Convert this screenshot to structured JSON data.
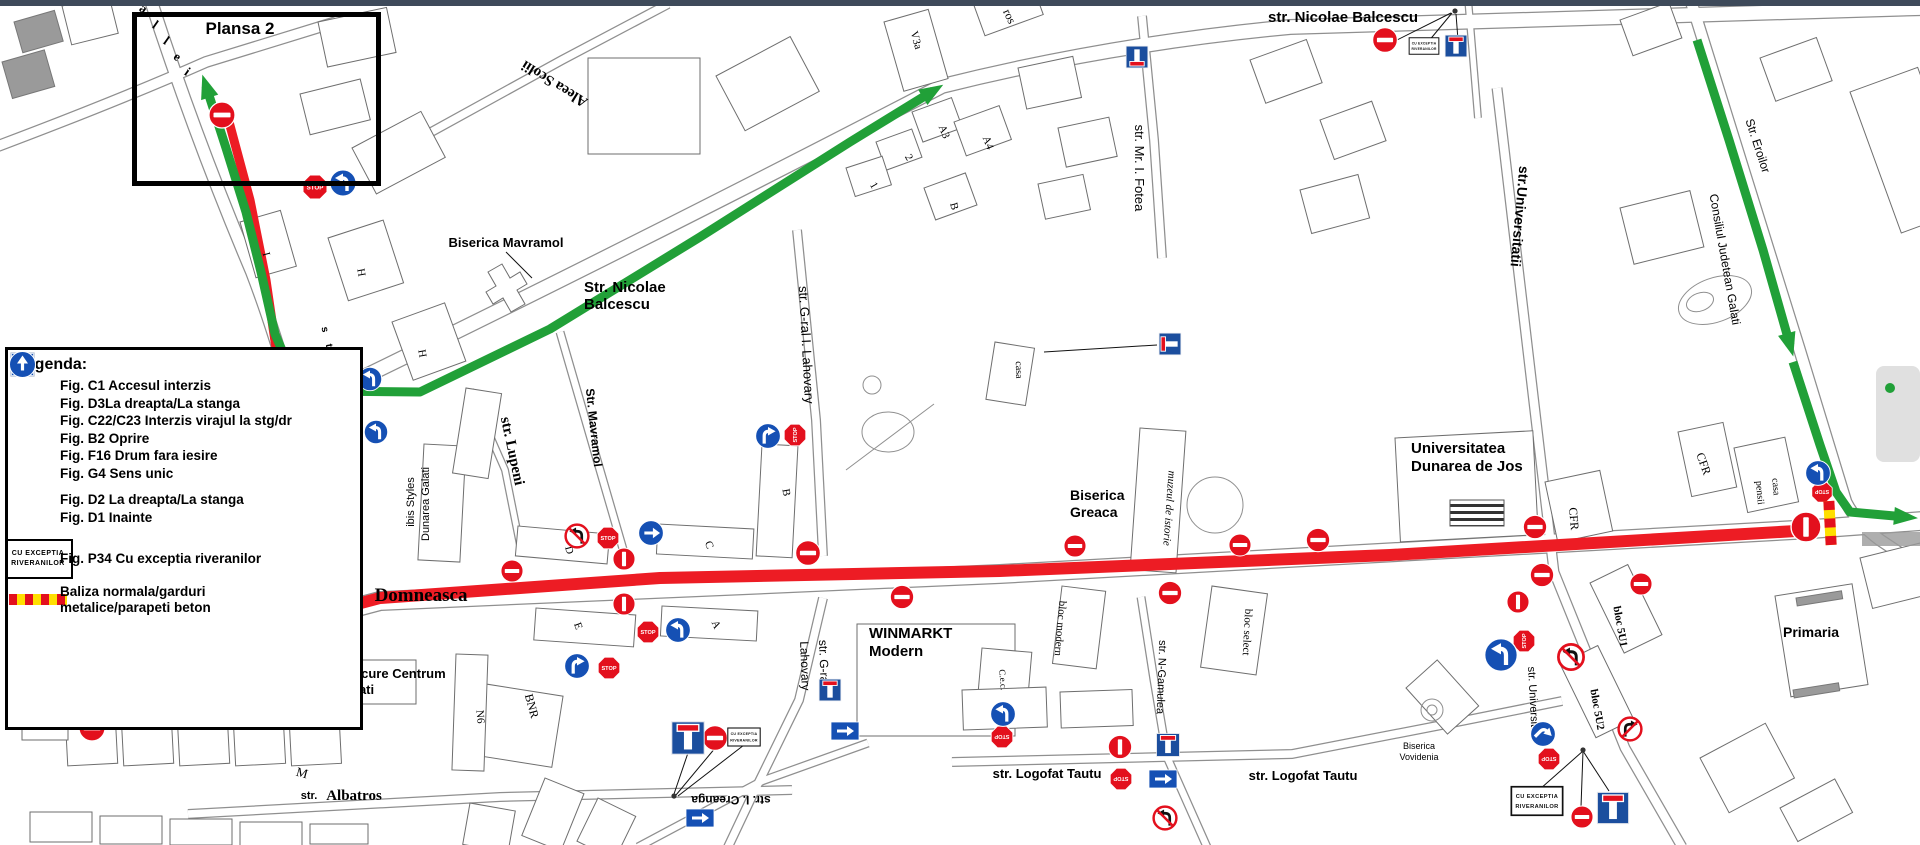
{
  "chrome": {
    "top_bar_color": "#3e4a5a"
  },
  "colors": {
    "route_red": "#ed1c24",
    "route_green": "#21a038",
    "sign_red": "#e3101d",
    "sign_blue": "#1550b4",
    "f16_blue": "#1b4e9e",
    "bal_yellow": "#ffdf00"
  },
  "plansa_box": {
    "label": "Plansa 2"
  },
  "sign_text": {
    "stop": "STOP",
    "p34_line1": "CU  EXCEPTIA",
    "p34_line2": "RIVERANILOR"
  },
  "legend": {
    "title": "Legenda:",
    "items": [
      {
        "icon": "ne",
        "label": "Fig. C1 Accesul interzis"
      },
      {
        "icon": "d3r",
        "label": "Fig. D3La dreapta/La stanga"
      },
      {
        "icon": "ntl",
        "label": "Fig. C22/C23 Interzis virajul la stg/dr"
      },
      {
        "icon": "st",
        "label": "Fig. B2 Oprire"
      },
      {
        "icon": "f16",
        "label": "Fig. F16 Drum fara iesire"
      },
      {
        "icon": "g4up",
        "label": "Fig. G4 Sens unic"
      },
      {
        "icon": "gap",
        "label": ""
      },
      {
        "icon": "d2r",
        "label": "Fig. D2 La dreapta/La stanga"
      },
      {
        "icon": "d1up",
        "label": "Fig. D1 Inainte"
      },
      {
        "icon": "gap",
        "label": ""
      },
      {
        "icon": "p34",
        "label": "Fig. P34 Cu exceptia riveranilor"
      },
      {
        "icon": "bal",
        "label": "Baliza normala/garduri",
        "label2": "metalice/parapeti beton"
      }
    ]
  },
  "street_labels": [
    {
      "t": "Plansa 2",
      "x": 240,
      "y": 34,
      "s": 17,
      "b": 1
    },
    {
      "t": "Aleea Scolii",
      "x": 557,
      "y": 80,
      "s": 15,
      "b": 1,
      "f": 1,
      "r": 212
    },
    {
      "t": "Biserica Mavramol",
      "x": 506,
      "y": 247,
      "s": 13,
      "b": 1
    },
    {
      "t": "Str. Nicolae",
      "x": 584,
      "y": 292,
      "s": 15,
      "b": 1,
      "a": "start"
    },
    {
      "t": "Balcescu",
      "x": 584,
      "y": 309,
      "s": 15,
      "b": 1,
      "a": "start"
    },
    {
      "t": "str. Nicolae Balcescu",
      "x": 1268,
      "y": 22,
      "s": 15,
      "b": 1,
      "a": "start"
    },
    {
      "t": "str. Mr. I. Fotea",
      "x": 1135,
      "y": 168,
      "s": 13,
      "r": 90
    },
    {
      "t": "str. G-ral I. Lahovary",
      "x": 802,
      "y": 345,
      "s": 13,
      "r": 87
    },
    {
      "t": "str. G-ral I.",
      "x": 820,
      "y": 668,
      "s": 12,
      "r": 88
    },
    {
      "t": "Lahovary",
      "x": 801,
      "y": 666,
      "s": 12,
      "r": 88
    },
    {
      "t": "Str. Mavramol",
      "x": 590,
      "y": 428,
      "s": 12,
      "b": 1,
      "r": 84
    },
    {
      "t": "str. Lupeni",
      "x": 508,
      "y": 452,
      "s": 15,
      "b": 1,
      "f": 1,
      "r": 78
    },
    {
      "t": "ibis Styles",
      "x": 414,
      "y": 502,
      "s": 11,
      "r": -90
    },
    {
      "t": "Dunarea Galati",
      "x": 429,
      "y": 504,
      "s": 11,
      "r": -90
    },
    {
      "t": "str.",
      "x": 352,
      "y": 599,
      "s": 13,
      "b": 1
    },
    {
      "t": "Domneasca",
      "x": 421,
      "y": 601,
      "s": 19,
      "b": 1,
      "f": 1
    },
    {
      "t": "Mercure Centrum",
      "x": 338,
      "y": 678,
      "s": 13,
      "b": 1,
      "a": "start"
    },
    {
      "t": "Galati",
      "x": 338,
      "y": 694,
      "s": 13,
      "b": 1,
      "a": "start"
    },
    {
      "t": "str.",
      "x": 309,
      "y": 799,
      "s": 11,
      "b": 1
    },
    {
      "t": "Albatros",
      "x": 354,
      "y": 800,
      "s": 15,
      "b": 1,
      "f": 1
    },
    {
      "t": "WINMARKT",
      "x": 869,
      "y": 638,
      "s": 15,
      "b": 1,
      "a": "start"
    },
    {
      "t": "Modern",
      "x": 869,
      "y": 656,
      "s": 15,
      "b": 1,
      "a": "start"
    },
    {
      "t": "str. I. Creanga",
      "x": 731,
      "y": 796,
      "s": 12,
      "b": 1,
      "r": 180
    },
    {
      "t": "str. Logofat Tautu",
      "x": 1047,
      "y": 778,
      "s": 13,
      "b": 1
    },
    {
      "t": "str. Logofat Tautu",
      "x": 1303,
      "y": 780,
      "s": 13,
      "b": 1
    },
    {
      "t": "str. N-Gamulea",
      "x": 1158,
      "y": 677,
      "s": 11,
      "r": 92
    },
    {
      "t": "bloc modern",
      "x": 1057,
      "y": 628,
      "s": 11,
      "f": 1,
      "r": 95
    },
    {
      "t": "bloc select",
      "x": 1244,
      "y": 632,
      "s": 11,
      "f": 1,
      "r": 93
    },
    {
      "t": "C.e.c.",
      "x": 1000,
      "y": 680,
      "s": 9,
      "f": 1,
      "r": 85
    },
    {
      "t": "muzeul de istorie",
      "x": 1166,
      "y": 508,
      "s": 11,
      "f": 1,
      "i": 1,
      "r": 94
    },
    {
      "t": "Biserica",
      "x": 1070,
      "y": 500,
      "s": 14,
      "b": 1,
      "a": "start"
    },
    {
      "t": "Greaca",
      "x": 1070,
      "y": 517,
      "s": 14,
      "b": 1,
      "a": "start"
    },
    {
      "t": "casa",
      "x": 1016,
      "y": 370,
      "s": 10,
      "f": 1,
      "r": 88
    },
    {
      "t": "Universitatea",
      "x": 1411,
      "y": 453,
      "s": 15,
      "b": 1,
      "a": "start"
    },
    {
      "t": "Dunarea de Jos",
      "x": 1411,
      "y": 471,
      "s": 15,
      "b": 1,
      "a": "start"
    },
    {
      "t": "CFR",
      "x": 1570,
      "y": 519,
      "s": 12,
      "f": 1,
      "r": 85
    },
    {
      "t": "CFR",
      "x": 1700,
      "y": 465,
      "s": 12,
      "f": 1,
      "r": 70
    },
    {
      "t": "casa",
      "x": 1773,
      "y": 487,
      "s": 10,
      "f": 1,
      "r": 85
    },
    {
      "t": "pensii",
      "x": 1757,
      "y": 493,
      "s": 10,
      "f": 1,
      "r": 85
    },
    {
      "t": "str.Universitatii",
      "x": 1515,
      "y": 216,
      "s": 14,
      "b": 1,
      "r": 95
    },
    {
      "t": "Str. Eroilor",
      "x": 1754,
      "y": 147,
      "s": 12,
      "r": 72
    },
    {
      "t": "Consiliul Judetean Galati",
      "x": 1721,
      "y": 260,
      "s": 12,
      "r": 80
    },
    {
      "t": "str. Universitatii",
      "x": 1530,
      "y": 704,
      "s": 11,
      "r": 87
    },
    {
      "t": "Primaria",
      "x": 1811,
      "y": 637,
      "s": 14,
      "b": 1
    },
    {
      "t": "Biserica",
      "x": 1419,
      "y": 749,
      "s": 9
    },
    {
      "t": "Vovidenia",
      "x": 1419,
      "y": 760,
      "s": 9
    },
    {
      "t": "bloc 5U1",
      "x": 1617,
      "y": 627,
      "s": 11,
      "b": 1,
      "f": 1,
      "r": 80
    },
    {
      "t": "bloc 5U2",
      "x": 1594,
      "y": 710,
      "s": 11,
      "b": 1,
      "f": 1,
      "r": 80
    },
    {
      "t": "V3a",
      "x": 913,
      "y": 41,
      "s": 11,
      "f": 1,
      "r": 75
    },
    {
      "t": "A3",
      "x": 941,
      "y": 133,
      "s": 11,
      "f": 1,
      "r": 68
    },
    {
      "t": "A4",
      "x": 985,
      "y": 144,
      "s": 11,
      "f": 1,
      "r": 68
    },
    {
      "t": "2",
      "x": 906,
      "y": 159,
      "s": 11,
      "f": 1,
      "r": 60
    },
    {
      "t": "1",
      "x": 871,
      "y": 187,
      "s": 11,
      "f": 1,
      "r": 60
    },
    {
      "t": "B",
      "x": 951,
      "y": 207,
      "s": 11,
      "f": 1,
      "r": 75
    },
    {
      "t": "ros",
      "x": 1006,
      "y": 18,
      "s": 12,
      "f": 1,
      "r": 65
    },
    {
      "t": "P1",
      "x": 49,
      "y": 621,
      "s": 11,
      "f": 1,
      "r": 88
    },
    {
      "t": "P2",
      "x": 47,
      "y": 722,
      "s": 11,
      "f": 1,
      "r": 88
    },
    {
      "t": "M",
      "x": 301,
      "y": 777,
      "s": 13,
      "f": 1,
      "r": 15
    },
    {
      "t": "N6",
      "x": 477,
      "y": 717,
      "s": 11,
      "f": 1,
      "r": 85
    },
    {
      "t": "BNR",
      "x": 528,
      "y": 707,
      "s": 12,
      "f": 1,
      "r": 75
    },
    {
      "t": "D",
      "x": 566,
      "y": 551,
      "s": 11,
      "f": 1,
      "r": 75
    },
    {
      "t": "C",
      "x": 706,
      "y": 546,
      "s": 11,
      "f": 1,
      "r": 70
    },
    {
      "t": "E",
      "x": 575,
      "y": 627,
      "s": 11,
      "f": 1,
      "r": 70
    },
    {
      "t": "A",
      "x": 713,
      "y": 626,
      "s": 11,
      "f": 1,
      "r": 65
    },
    {
      "t": "B",
      "x": 783,
      "y": 493,
      "s": 11,
      "f": 1,
      "r": 80
    },
    {
      "t": "H",
      "x": 358,
      "y": 273,
      "s": 11,
      "f": 1,
      "r": 80
    },
    {
      "t": "H",
      "x": 419,
      "y": 354,
      "s": 11,
      "f": 1,
      "r": 80
    },
    {
      "t": "I",
      "x": 263,
      "y": 255,
      "s": 11,
      "f": 1,
      "r": 75
    },
    {
      "t": "a",
      "x": 141,
      "y": 12,
      "s": 13,
      "b": 1,
      "f": 1,
      "r": 35
    },
    {
      "t": "l",
      "x": 153,
      "y": 28,
      "s": 13,
      "b": 1,
      "f": 1,
      "r": 35
    },
    {
      "t": "l",
      "x": 164,
      "y": 44,
      "s": 13,
      "b": 1,
      "f": 1,
      "r": 35
    },
    {
      "t": "e",
      "x": 175,
      "y": 60,
      "s": 13,
      "b": 1,
      "f": 1,
      "r": 35
    },
    {
      "t": "i",
      "x": 185,
      "y": 75,
      "s": 13,
      "b": 1,
      "f": 1,
      "r": 35
    },
    {
      "t": "s",
      "x": 322,
      "y": 330,
      "s": 10,
      "b": 1,
      "r": 80
    },
    {
      "t": "t",
      "x": 326,
      "y": 346,
      "s": 10,
      "b": 1,
      "r": 80
    },
    {
      "t": "r",
      "x": 330,
      "y": 362,
      "s": 10,
      "b": 1,
      "r": 80
    },
    {
      "t": "a",
      "x": 330,
      "y": 476,
      "s": 10,
      "b": 1,
      "r": 80
    },
    {
      "t": "l",
      "x": 333,
      "y": 504,
      "s": 10,
      "b": 1,
      "r": 80
    },
    {
      "t": "e",
      "x": 336,
      "y": 532,
      "s": 10,
      "b": 1,
      "r": 80
    },
    {
      "t": "a",
      "x": 339,
      "y": 558,
      "s": 10,
      "b": 1,
      "r": 80
    }
  ],
  "routes": [
    {
      "pts": [
        [
          62,
          682
        ],
        [
          380,
          598
        ],
        [
          660,
          578
        ],
        [
          1000,
          571
        ],
        [
          1390,
          555
        ],
        [
          1796,
          531
        ]
      ],
      "c": "red",
      "w": 12,
      "arrow": "none"
    },
    {
      "pts": [
        [
          228,
          118
        ],
        [
          250,
          200
        ],
        [
          266,
          280
        ],
        [
          277,
          355
        ],
        [
          288,
          420
        ],
        [
          312,
          450
        ],
        [
          322,
          505
        ],
        [
          332,
          556
        ],
        [
          346,
          604
        ]
      ],
      "c": "red",
      "w": 9,
      "arrow": "none"
    },
    {
      "pts": [
        [
          206,
          86
        ],
        [
          226,
          148
        ],
        [
          246,
          212
        ],
        [
          261,
          272
        ],
        [
          275,
          334
        ],
        [
          291,
          371
        ],
        [
          317,
          391
        ],
        [
          420,
          392
        ],
        [
          550,
          329
        ],
        [
          700,
          237
        ],
        [
          850,
          142
        ],
        [
          933,
          91
        ]
      ],
      "c": "green",
      "w": 9,
      "arrow": "both"
    },
    {
      "pts": [
        [
          1697,
          40
        ],
        [
          1729,
          140
        ],
        [
          1763,
          250
        ],
        [
          1790,
          345
        ]
      ],
      "c": "green",
      "w": 9,
      "arrow": "end"
    },
    {
      "pts": [
        [
          1793,
          362
        ],
        [
          1820,
          445
        ],
        [
          1836,
          492
        ],
        [
          1850,
          512
        ],
        [
          1906,
          517
        ]
      ],
      "c": "green",
      "w": 9,
      "arrow": "end"
    }
  ],
  "signs": [
    {
      "k": "ne",
      "x": 222,
      "y": 115
    },
    {
      "k": "ne",
      "x": 327,
      "y": 459
    },
    {
      "k": "ne",
      "x": 92,
      "y": 728
    },
    {
      "k": "ne",
      "x": 512,
      "y": 571,
      "s": 0.85
    },
    {
      "k": "ne",
      "x": 624,
      "y": 559,
      "r": 90,
      "s": 0.85
    },
    {
      "k": "ne",
      "x": 624,
      "y": 604,
      "r": 90,
      "s": 0.85
    },
    {
      "k": "ne",
      "x": 808,
      "y": 553,
      "s": 0.95
    },
    {
      "k": "ne",
      "x": 902,
      "y": 597,
      "s": 0.9
    },
    {
      "k": "ne",
      "x": 1075,
      "y": 546,
      "s": 0.85
    },
    {
      "k": "ne",
      "x": 1170,
      "y": 593,
      "s": 0.9
    },
    {
      "k": "ne",
      "x": 1240,
      "y": 545,
      "s": 0.85
    },
    {
      "k": "ne",
      "x": 1318,
      "y": 540,
      "s": 0.9
    },
    {
      "k": "ne",
      "x": 1385,
      "y": 40,
      "s": 0.95
    },
    {
      "k": "ne",
      "x": 1535,
      "y": 527,
      "s": 0.9
    },
    {
      "k": "ne",
      "x": 1542,
      "y": 575,
      "s": 0.9
    },
    {
      "k": "ne",
      "x": 1641,
      "y": 584,
      "s": 0.85
    },
    {
      "k": "ne",
      "x": 1518,
      "y": 602,
      "r": 90,
      "s": 0.85
    },
    {
      "k": "ne",
      "x": 715,
      "y": 738,
      "s": 0.95
    },
    {
      "k": "ne",
      "x": 1120,
      "y": 747,
      "r": 90,
      "s": 0.9
    },
    {
      "k": "ne",
      "x": 1582,
      "y": 817,
      "s": 0.85
    },
    {
      "k": "ne",
      "x": 1806,
      "y": 527,
      "r": 90,
      "s": 1.15
    },
    {
      "k": "st",
      "x": 315,
      "y": 187
    },
    {
      "k": "st",
      "x": 795,
      "y": 435,
      "r": -90,
      "s": 0.9
    },
    {
      "k": "st",
      "x": 608,
      "y": 538,
      "s": 0.9
    },
    {
      "k": "st",
      "x": 648,
      "y": 632,
      "s": 0.9
    },
    {
      "k": "st",
      "x": 609,
      "y": 668,
      "s": 0.9
    },
    {
      "k": "st",
      "x": 1002,
      "y": 737,
      "r": 180,
      "s": 0.9
    },
    {
      "k": "st",
      "x": 1121,
      "y": 779,
      "r": 180,
      "s": 0.9
    },
    {
      "k": "st",
      "x": 1524,
      "y": 641,
      "r": -90,
      "s": 0.9
    },
    {
      "k": "st",
      "x": 1549,
      "y": 759,
      "r": 180,
      "s": 0.9
    },
    {
      "k": "st",
      "x": 1822,
      "y": 492,
      "r": 180,
      "s": 0.85
    },
    {
      "k": "f16",
      "x": 1456,
      "y": 46,
      "s": 0.9
    },
    {
      "k": "f16",
      "x": 1137,
      "y": 57,
      "r": 180,
      "s": 0.9
    },
    {
      "k": "f16",
      "x": 1170,
      "y": 344,
      "r": -90,
      "s": 0.9
    },
    {
      "k": "f16",
      "x": 830,
      "y": 690,
      "s": 0.9
    },
    {
      "k": "f16",
      "x": 688,
      "y": 738,
      "s": 1.35
    },
    {
      "k": "f16",
      "x": 1168,
      "y": 745,
      "s": 0.95
    },
    {
      "k": "f16",
      "x": 1613,
      "y": 808,
      "s": 1.3
    },
    {
      "k": "g4",
      "x": 845,
      "y": 731
    },
    {
      "k": "g4",
      "x": 1163,
      "y": 779
    },
    {
      "k": "g4",
      "x": 700,
      "y": 818
    },
    {
      "k": "d2r",
      "x": 651,
      "y": 533,
      "s": 0.95
    },
    {
      "k": "d3r",
      "x": 768,
      "y": 436,
      "s": 0.95
    },
    {
      "k": "d3r",
      "x": 577,
      "y": 666,
      "s": 0.95
    },
    {
      "k": "d3r",
      "x": 1543,
      "y": 734,
      "r": 45,
      "s": 0.95
    },
    {
      "k": "d3l",
      "x": 343,
      "y": 183
    },
    {
      "k": "d3l",
      "x": 370,
      "y": 379,
      "s": 0.9
    },
    {
      "k": "d3l",
      "x": 376,
      "y": 432,
      "s": 0.9
    },
    {
      "k": "d3l",
      "x": 678,
      "y": 630,
      "s": 0.95
    },
    {
      "k": "d3l",
      "x": 1003,
      "y": 714,
      "s": 0.95
    },
    {
      "k": "d3l",
      "x": 1501,
      "y": 655,
      "s": 1.25
    },
    {
      "k": "d3l",
      "x": 1818,
      "y": 473,
      "s": 0.95
    },
    {
      "k": "ntl",
      "x": 577,
      "y": 536,
      "s": 0.95
    },
    {
      "k": "ntl",
      "x": 1571,
      "y": 657,
      "s": 1.05
    },
    {
      "k": "ntl",
      "x": 1165,
      "y": 818,
      "s": 0.95
    },
    {
      "k": "ntr",
      "x": 1630,
      "y": 729,
      "s": 0.95
    },
    {
      "k": "p34",
      "x": 1424,
      "y": 46,
      "s": 0.55
    },
    {
      "k": "p34",
      "x": 744,
      "y": 737,
      "s": 0.6
    },
    {
      "k": "p34",
      "x": 1537,
      "y": 801,
      "s": 0.95
    },
    {
      "k": "bal",
      "x": 333,
      "y": 438,
      "r": 3
    },
    {
      "k": "bal",
      "x": 88,
      "y": 707,
      "r": -4
    },
    {
      "k": "bal",
      "x": 1830,
      "y": 523,
      "r": 87
    },
    {
      "k": "dg",
      "x": 1890,
      "y": 388
    }
  ],
  "leader_lines": [
    [
      1389,
      44,
      1451,
      13
    ],
    [
      1428,
      42,
      1452,
      13
    ],
    [
      1458,
      40,
      1456,
      14
    ],
    [
      1583,
      751,
      1531,
      797
    ],
    [
      1583,
      751,
      1581,
      807
    ],
    [
      1583,
      751,
      1609,
      791
    ],
    [
      690,
      747,
      674,
      794
    ],
    [
      716,
      747,
      676,
      795
    ],
    [
      744,
      745,
      678,
      796
    ],
    [
      506,
      252,
      532,
      278
    ],
    [
      1044,
      352,
      1157,
      345
    ]
  ],
  "leader_dots": [
    [
      1455,
      11
    ],
    [
      1583,
      750
    ],
    [
      674,
      796
    ]
  ]
}
